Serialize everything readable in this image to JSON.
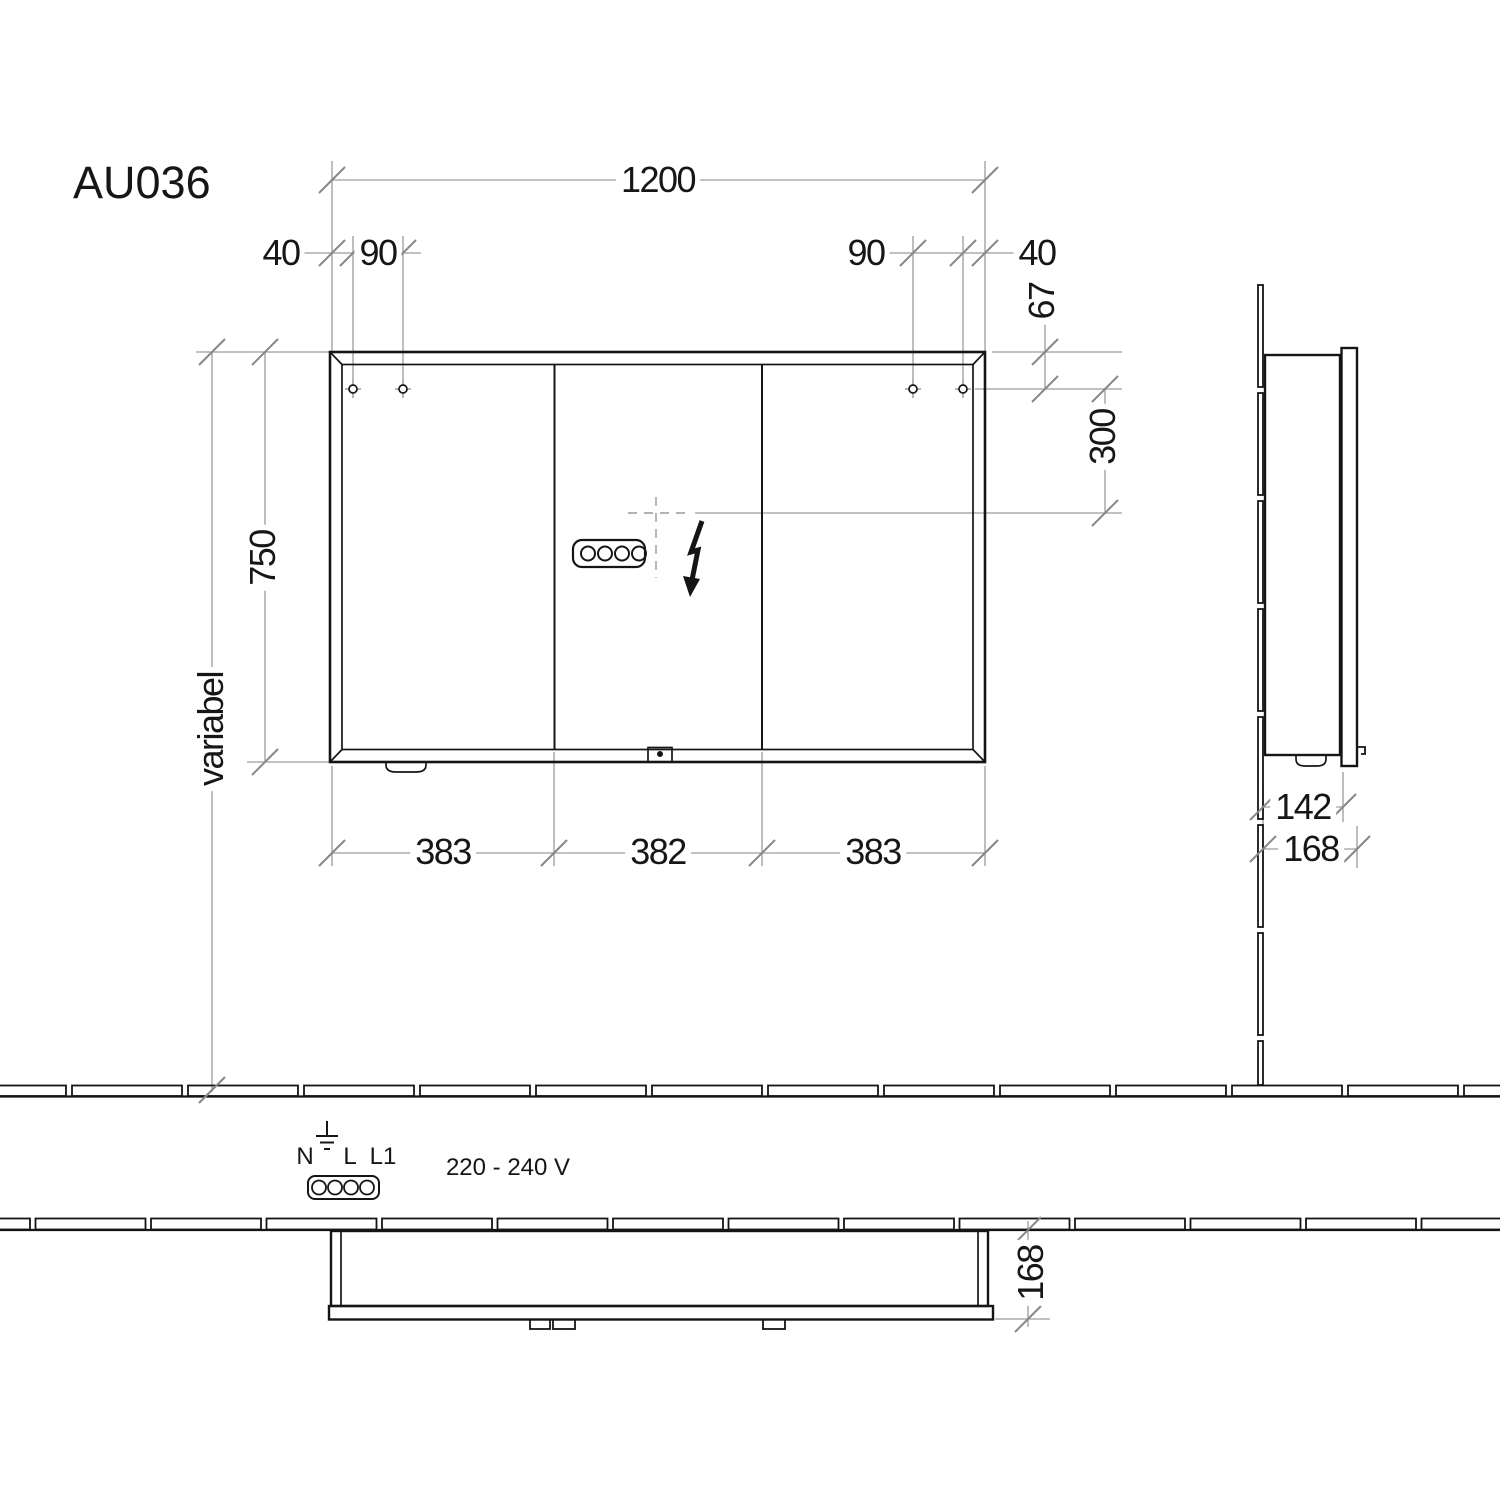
{
  "title": "AU036",
  "dims": {
    "front": {
      "width": "1200",
      "hole_edge_left": "40",
      "hole_spacing_left": "90",
      "hole_spacing_right": "90",
      "hole_edge_right": "40",
      "hole_top_offset": "67",
      "outlet_drop": "300",
      "height": "750",
      "height_variable": "variabel",
      "doors": [
        "383",
        "382",
        "383"
      ]
    },
    "side": {
      "body_depth": "142",
      "total_depth": "168"
    },
    "plan": {
      "total_depth": "168"
    }
  },
  "electrical": {
    "terminal_n": "N",
    "terminal_l": "L",
    "terminal_l1": "L1",
    "voltage": "220 - 240 V"
  },
  "colors": {
    "line_black": "#151515",
    "line_gray": "#9c9c9c",
    "tick_gray": "#878787"
  }
}
